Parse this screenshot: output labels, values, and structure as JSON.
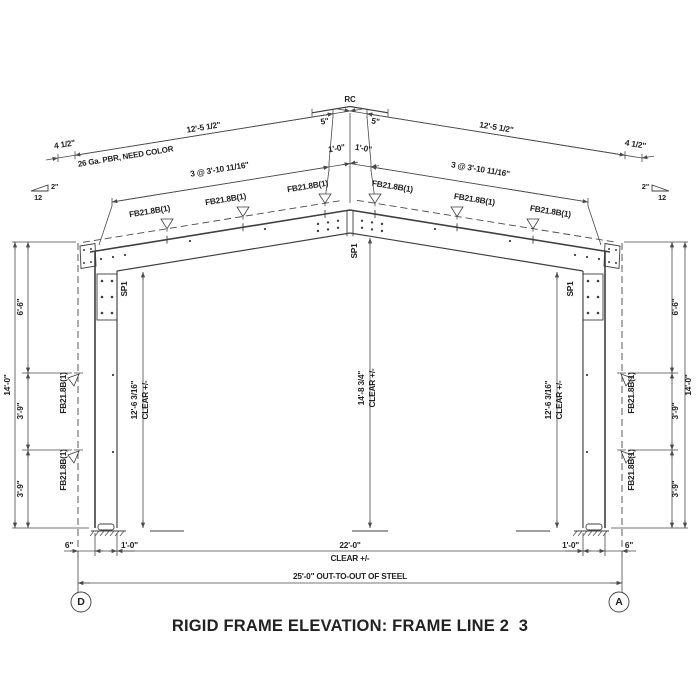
{
  "drawing": {
    "title": "RIGID FRAME ELEVATION: FRAME LINE 2  3",
    "ridge_cap_label": "RC",
    "panel_note": "26 Ga. PBR, NEED COLOR",
    "slope": {
      "rise": "2\"",
      "run": "12"
    },
    "roof_dims": {
      "edge": "4 1/2\"",
      "panel": "12'-5 1/2\"",
      "ridge_offset": "5\"",
      "first_purlin": "1'-0\"",
      "purlin_spacing": "3 @ 3'-10 11/16\""
    },
    "member_labels": {
      "flange_brace": "FB21.8B(1)",
      "splice": "SP1"
    },
    "wall_dims": {
      "overall": "14'-0\"",
      "seg_top": "6'-6\"",
      "seg_mid": "3'-9\"",
      "seg_bot": "3'-9\""
    },
    "clear_dims": {
      "center_height": "14'-8 3/4\"",
      "side_height": "12'-6 3/16\"",
      "suffix": "CLEAR +/-",
      "width": "22'-0\""
    },
    "base_dims": {
      "offset": "6\"",
      "inset": "1'-0\"",
      "out_to_out": "25'-0\" OUT-TO-OUT OF STEEL"
    },
    "grid": {
      "left": "D",
      "right": "A"
    }
  }
}
